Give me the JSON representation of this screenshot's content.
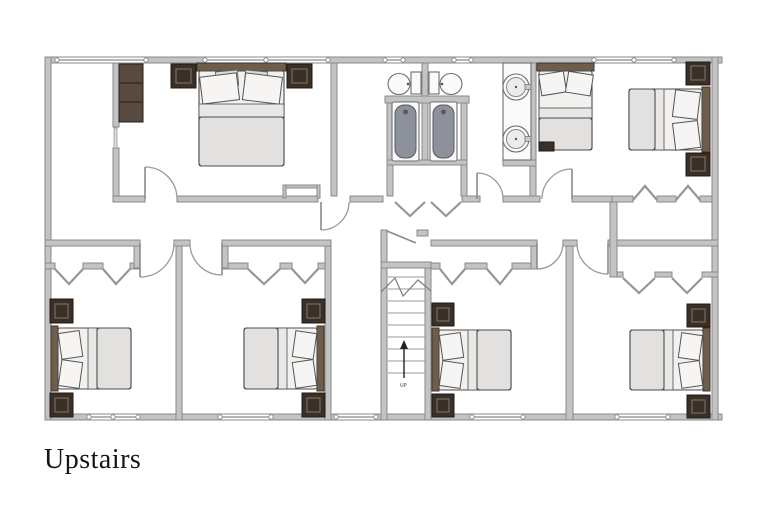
{
  "title": {
    "label": "Upstairs"
  },
  "stairs": {
    "direction_label": "UP"
  },
  "colors": {
    "wall": "#c3c3c3",
    "wallstroke": "#8a8a8a",
    "dark": "#3a3028",
    "wood": "#6f5d49",
    "tub": "#8d919b",
    "ink": "#151515",
    "paper": "#ffffff"
  },
  "inventory": {
    "bedrooms_visible": 6,
    "beds": 7,
    "nightstands": 12,
    "wardrobe_units": 1,
    "toilets": 2,
    "bathtubs": 2,
    "vanity_sinks": 2,
    "staircases": 1
  }
}
